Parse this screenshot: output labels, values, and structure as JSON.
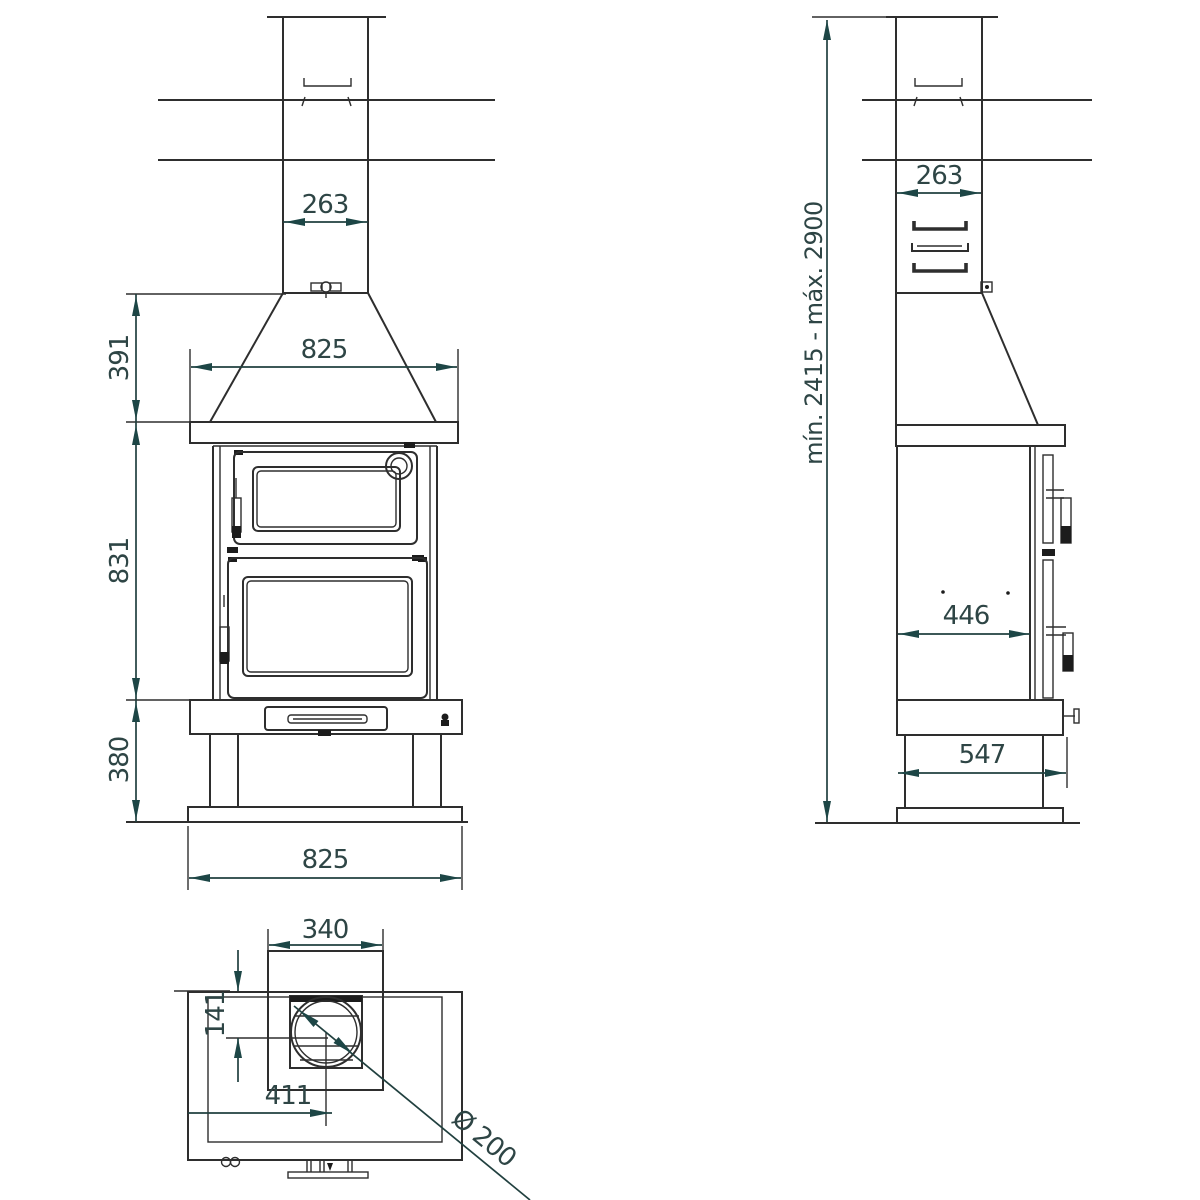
{
  "drawing_title": "Wood stove with oven - dimensional drawing (front, side and top views)",
  "colors": {
    "background": "#ffffff",
    "line": "#2e2e2e",
    "dimension_accent": "#1d4646",
    "dimension_text": "#2e4545"
  },
  "views": {
    "front": {
      "dims": {
        "chimney_width": "263",
        "hood_width": "825",
        "hood_height": "391",
        "body_height": "831",
        "base_height": "380",
        "base_width": "825"
      }
    },
    "side": {
      "dims": {
        "chimney_depth": "263",
        "body_depth": "446",
        "base_depth": "547",
        "total_height_range": "mín. 2415 - máx. 2900"
      }
    },
    "top": {
      "dims": {
        "flue_box_width": "340",
        "flue_center_offset_back": "141",
        "flue_center_offset_left": "411",
        "flue_diameter": "Ø 200"
      }
    }
  }
}
